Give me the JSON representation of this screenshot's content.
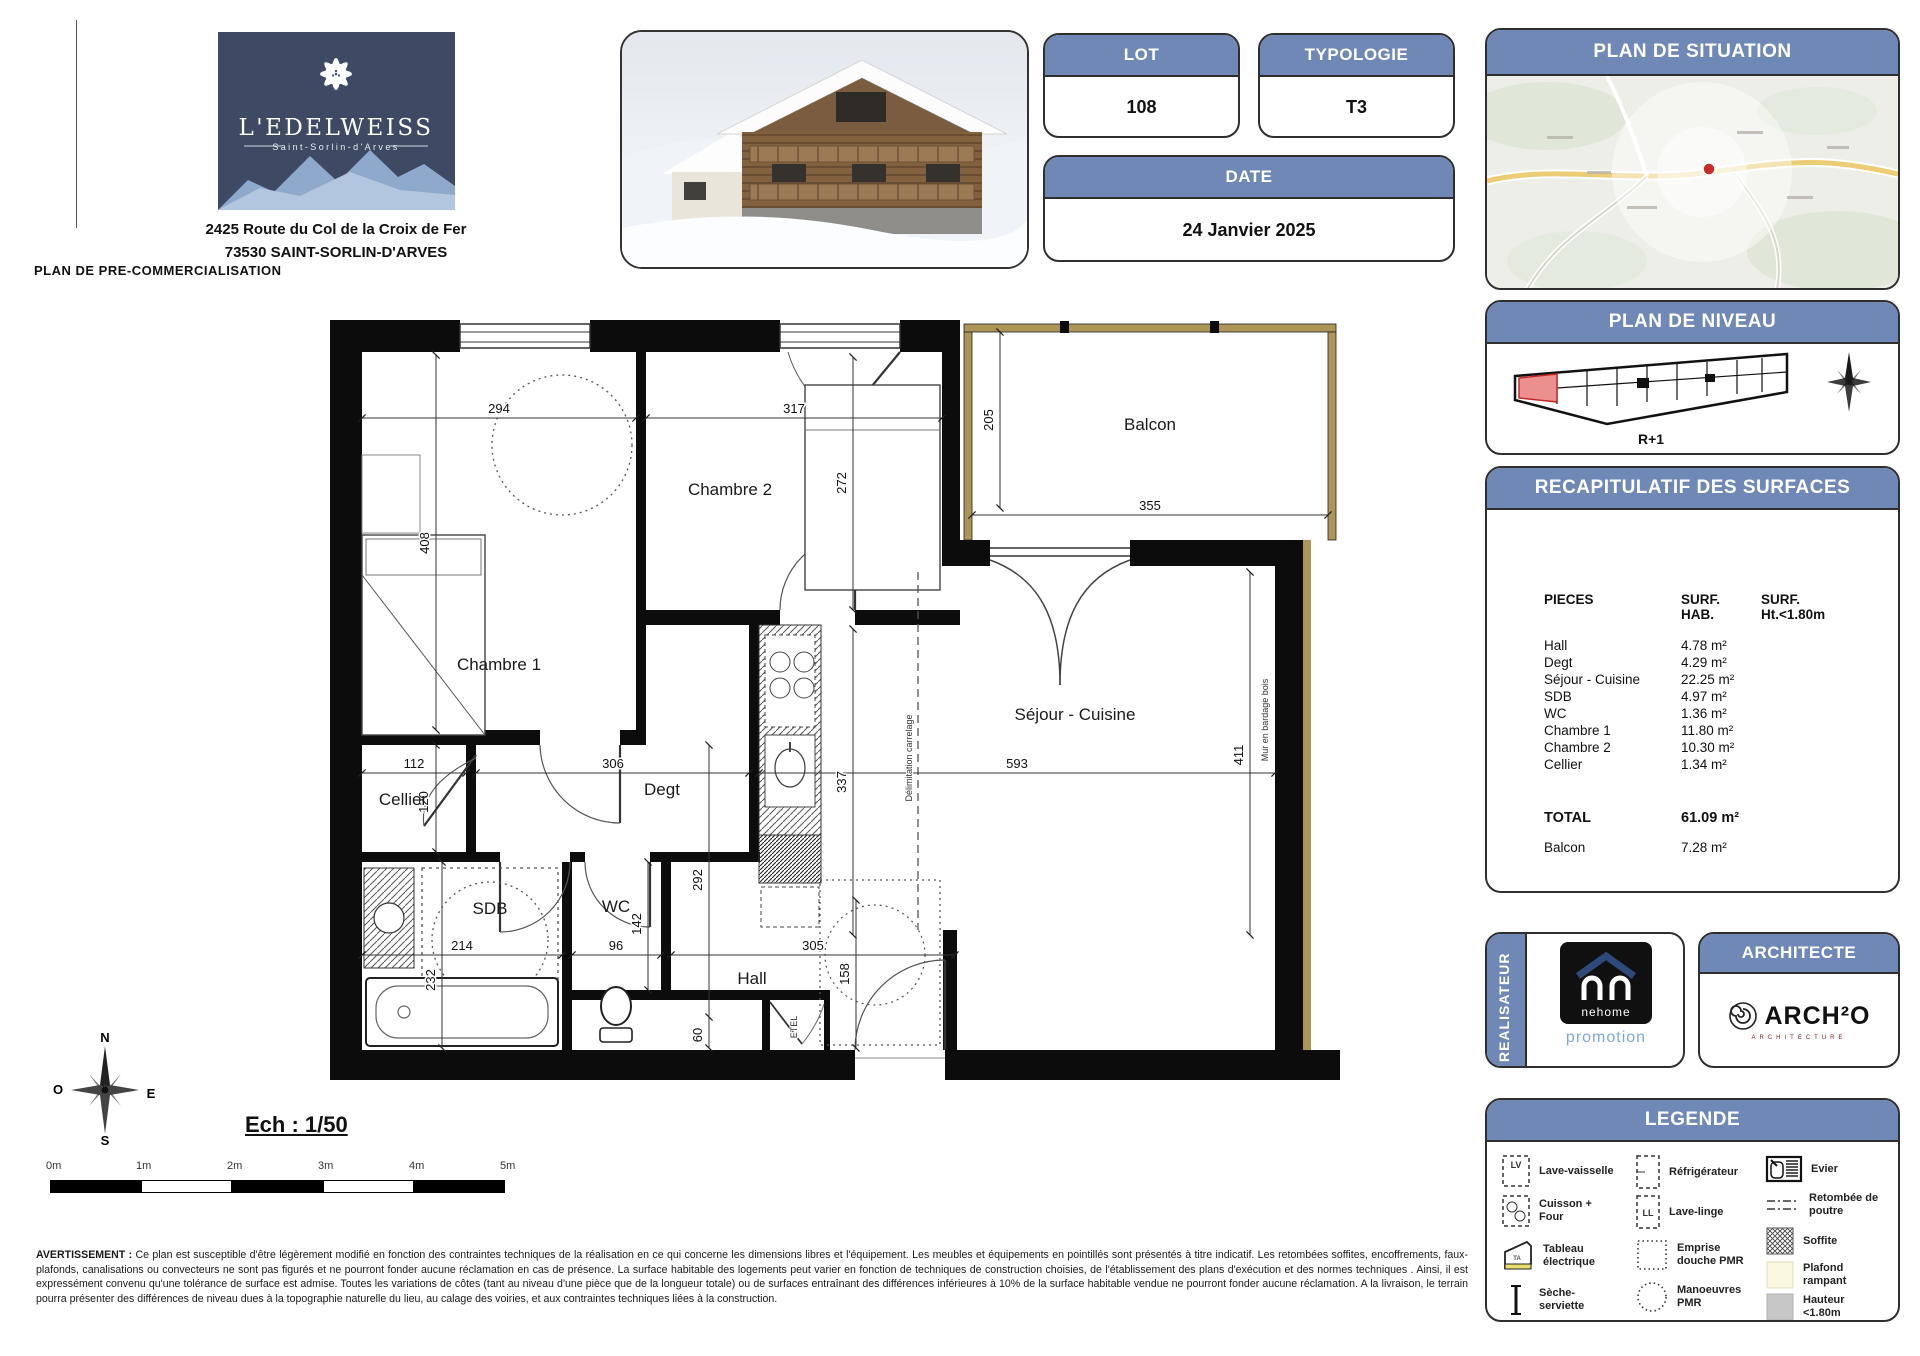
{
  "page": {
    "doc_label": "PLAN DE PRE-COMMERCIALISATION"
  },
  "project": {
    "name": "L'EDELWEISS",
    "place": "Saint-Sorlin-d'Arves",
    "address1": "2425 Route du Col de la Croix de Fer",
    "address2": "73530 SAINT-SORLIN-D'ARVES"
  },
  "info": {
    "lot_label": "LOT",
    "lot_value": "108",
    "typologie_label": "TYPOLOGIE",
    "typologie_value": "T3",
    "date_label": "DATE",
    "date_value": "24 Janvier 2025"
  },
  "situation": {
    "title": "PLAN DE SITUATION"
  },
  "niveau": {
    "title": "PLAN DE NIVEAU",
    "level": "R+1"
  },
  "surfaces": {
    "title": "RECAPITULATIF DES SURFACES",
    "col1": "PIECES",
    "col2a": "SURF.",
    "col2b": "HAB.",
    "col3a": "SURF.",
    "col3b": "Ht.<1.80m",
    "rows": [
      {
        "name": "Hall",
        "hab": "4.78 m²"
      },
      {
        "name": "Degt",
        "hab": "4.29 m²"
      },
      {
        "name": "Séjour - Cuisine",
        "hab": "22.25 m²"
      },
      {
        "name": "SDB",
        "hab": "4.97 m²"
      },
      {
        "name": "WC",
        "hab": "1.36 m²"
      },
      {
        "name": "Chambre 1",
        "hab": "11.80 m²"
      },
      {
        "name": "Chambre 2",
        "hab": "10.30 m²"
      },
      {
        "name": "Cellier",
        "hab": "1.34 m²"
      }
    ],
    "total_label": "TOTAL",
    "total_value": "61.09 m²",
    "balcon_label": "Balcon",
    "balcon_value": "7.28 m²"
  },
  "realisateur": {
    "title": "REALISATEUR",
    "brand": "nehome",
    "brand_sub": "promotion"
  },
  "architecte": {
    "title": "ARCHITECTE",
    "brand": "ARCH²O",
    "brand_sub": "ARCHITECTURE"
  },
  "legende": {
    "title": "LEGENDE",
    "lv": "Lave-vaisselle",
    "cuisson": "Cuisson + Four",
    "tableau": "Tableau électrique",
    "seche": "Sèche-serviette",
    "refrigerateur": "Réfrigérateur",
    "lavelinge": "Lave-linge",
    "emprise": "Emprise douche PMR",
    "manoeuvres": "Manoeuvres PMR",
    "evier": "Evier",
    "retombee": "Retombée de poutre",
    "soffite": "Soffite",
    "plafond": "Plafond rampant",
    "hauteur": "Hauteur <1.80m"
  },
  "plan": {
    "rooms": {
      "chambre1": "Chambre 1",
      "chambre2": "Chambre 2",
      "balcon": "Balcon",
      "sejour": "Séjour - Cuisine",
      "cellier": "Cellier",
      "degt": "Degt",
      "sdb": "SDB",
      "wc": "WC",
      "hall": "Hall"
    },
    "notes": {
      "etel": "ETEL",
      "mur": "Mur en bardage bois",
      "carrelage": "Délimitation carrelage"
    },
    "dims": {
      "c1w": "294",
      "c2w": "317",
      "balh": "205",
      "balw": "355",
      "c2h": "272",
      "c1h": "408",
      "cuih": "337",
      "sejh": "411",
      "celw": "112",
      "celh": "120",
      "degw": "306",
      "sejw": "593",
      "sdbw": "214",
      "sdbh": "232",
      "wcw": "96",
      "wch": "142",
      "hallh": "292",
      "hallw": "305",
      "enth": "158",
      "clos": "60"
    }
  },
  "footer": {
    "scale_label": "Ech : 1/50",
    "ticks": [
      "0m",
      "1m",
      "2m",
      "3m",
      "4m",
      "5m"
    ],
    "compass": {
      "n": "N",
      "s": "S",
      "e": "E",
      "o": "O"
    },
    "warning_label": "AVERTISSEMENT :",
    "warning_text": "Ce plan est susceptible d'être légèrement modifié en fonction des contraintes techniques de la réalisation en ce qui concerne les dimensions libres et l'équipement. Les meubles et équipements en pointillés sont présentés à titre indicatif. Les retombées soffites, encoffrements, faux-plafonds, canalisations ou convecteurs ne sont pas figurés et ne pourront fonder aucune réclamation en cas de présence. La surface habitable des logements peut varier en fonction de techniques de construction choisies, de l'établissement des plans d'exécution et des normes techniques . Ainsi, il est expressément convenu qu'une tolérance de surface est admise. Toutes les variations de côtes (tant au niveau d'une pièce que de la longueur totale) ou de surfaces entraînant des différences inférieures à 10% de la surface habitable vendue ne pourront fonder aucune réclamation. A la livraison, le terrain pourra présenter des différences de niveau dues à la topographie naturelle du lieu, au calage des voiries, et aux contraintes techniques liées à la construction."
  }
}
